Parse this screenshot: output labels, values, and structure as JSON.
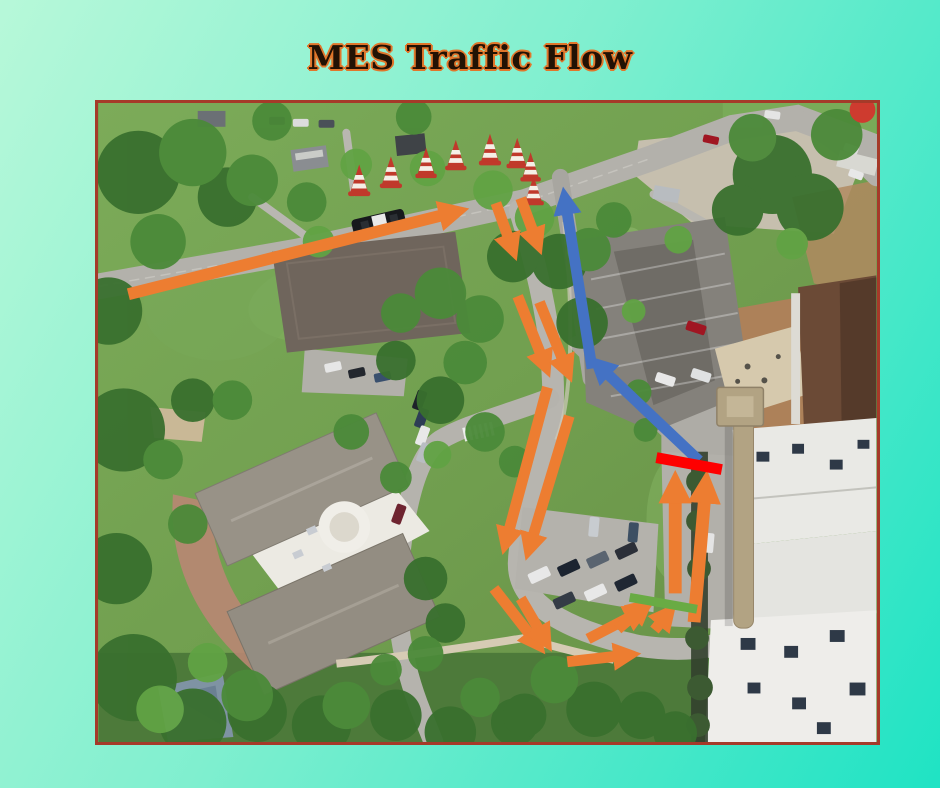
{
  "slide": {
    "title": "MES Traffic Flow"
  },
  "colors": {
    "bg_start": "#b7f8d9",
    "bg_mid": "#7fefcf",
    "bg_end": "#1fe3c4",
    "title_fill": "#221204",
    "title_outline": "#e1762b",
    "map_border": "#a53a29",
    "arrow_orange": "#ED7D31",
    "arrow_blue": "#4472C4",
    "stop_bar": "#FE0000",
    "go_bar": "#69AB44",
    "cone_body": "#C0392B",
    "cone_stripe": "#F5EFE6"
  },
  "map": {
    "description": "aerial photo of MES campus with traffic flow overlay",
    "annotations": {
      "traffic_cones": {
        "count": 8
      },
      "orange_route_arrows": {
        "count": 15
      },
      "blue_route_arrows": {
        "count": 2
      },
      "stop_bar": {
        "color": "#FE0000"
      },
      "go_bar": {
        "color": "#69AB44"
      },
      "police_car": {
        "count": 1
      }
    }
  }
}
